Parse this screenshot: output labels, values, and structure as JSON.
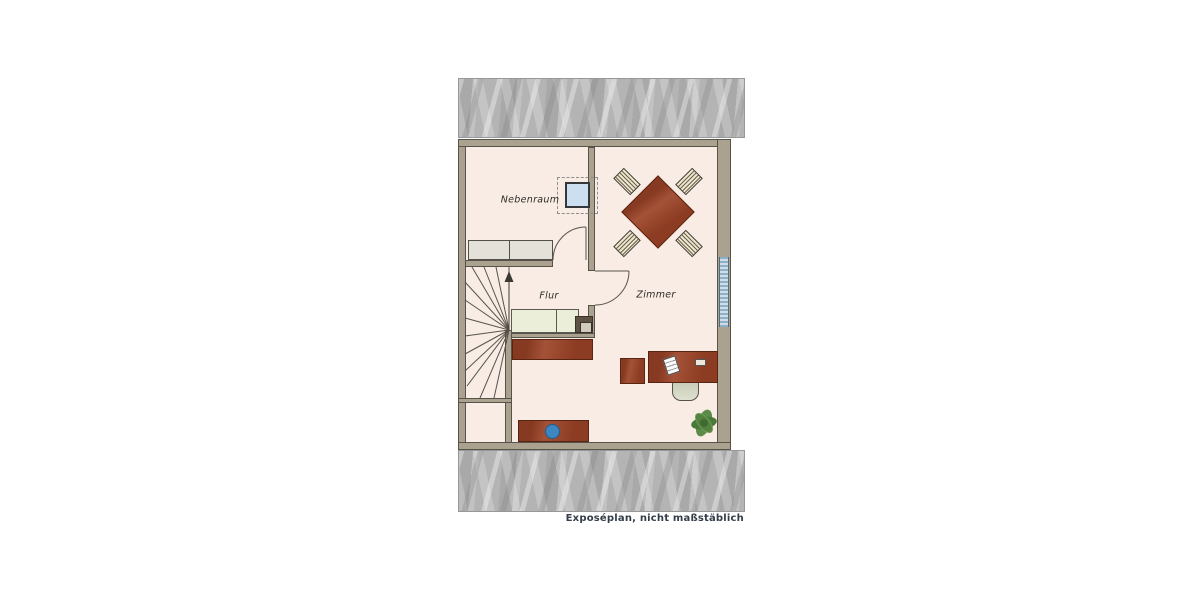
{
  "caption": "Exposéplan, nicht maßstäblich",
  "rooms": [
    {
      "name": "nebenraum",
      "label": "Nebenraum"
    },
    {
      "name": "flur",
      "label": "Flur"
    },
    {
      "name": "zimmer",
      "label": "Zimmer"
    }
  ],
  "furniture_icons": [
    "winder-staircase",
    "stair-direction-arrow",
    "built-in-wardrobe",
    "skylight-window",
    "door-swing-nebenraum",
    "door-swing-zimmer",
    "dining-table",
    "dining-chair",
    "hall-cabinet",
    "sideboard",
    "sideboard-with-basin",
    "desk",
    "desk-chair",
    "side-table",
    "paper-sheet",
    "potted-plant",
    "facade-window",
    "roof-hatch-area"
  ],
  "colors": {
    "page_bg": "#ffffff",
    "floor": "#f8ece4",
    "wall_fill": "#aba18f",
    "wall_line": "#57534a",
    "roof_gray": "#b4b4b4",
    "wood_red": "#9c4326",
    "wood_line": "#5a2413",
    "chair_cream": "#ece5cc",
    "chair_line": "#6c6251",
    "cabinet_green": "#ebeed8",
    "cabinet_gray": "#e4e1d8",
    "skylight_blue": "#cbdff0",
    "window_blue": "#8fb0c4",
    "plant_green": "#5f9049",
    "basin_blue": "#3e86c1",
    "label_ink": "#2f2c28",
    "caption_ink": "#333e49"
  }
}
